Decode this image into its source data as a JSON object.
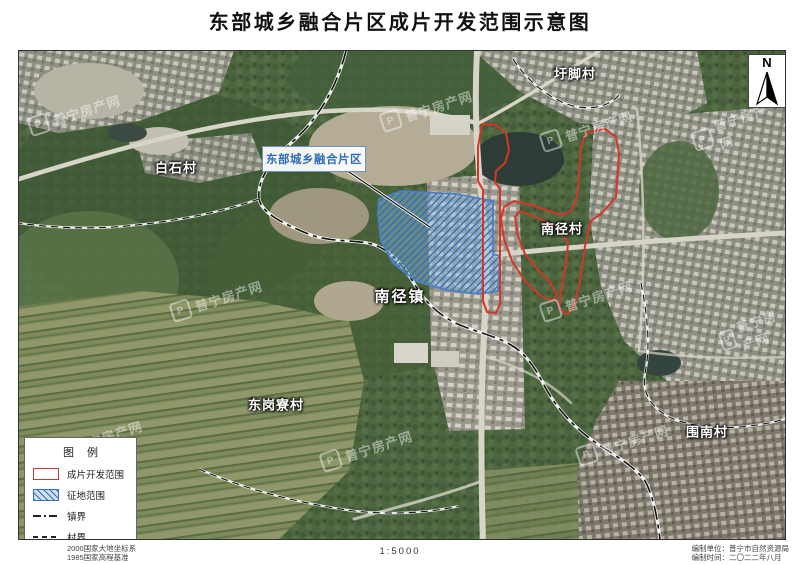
{
  "page": {
    "title": "东部城乡融合片区成片开发范围示意图"
  },
  "map": {
    "north_label": "N",
    "callout": {
      "text": "东部城乡融合片区"
    },
    "labels": [
      {
        "id": "xujiao-village",
        "text": "圩脚村"
      },
      {
        "id": "baishi-village",
        "text": "白石村"
      },
      {
        "id": "nanjing-village",
        "text": "南径村"
      },
      {
        "id": "nanjing-town",
        "text": "南径镇"
      },
      {
        "id": "donggangliao-village",
        "text": "东岗寮村"
      },
      {
        "id": "weinan-village",
        "text": "围南村"
      }
    ],
    "watermark": {
      "text": "普宁房产网",
      "logo_letter": "P"
    }
  },
  "legend": {
    "title": "图 例",
    "items": [
      {
        "label": "成片开发范围",
        "swatch": "red-outline"
      },
      {
        "label": "征地范围",
        "swatch": "blue-hatch"
      },
      {
        "label": "镇界",
        "swatch": "dash-dot-line"
      },
      {
        "label": "村界",
        "swatch": "dashed-line"
      }
    ]
  },
  "footer": {
    "datum_line1": "2000国家大地坐标系",
    "datum_line2": "1985国家高程基准",
    "scale": "1:5000",
    "credit_line1": "编制单位：普宁市自然资源局",
    "credit_line2": "编制时间：二〇二二年八月"
  },
  "colors": {
    "development_outline": "#d23727",
    "acquisition_border": "#4a80c4",
    "acquisition_fill": "#8cb4de",
    "callout_text": "#2f6db8"
  }
}
